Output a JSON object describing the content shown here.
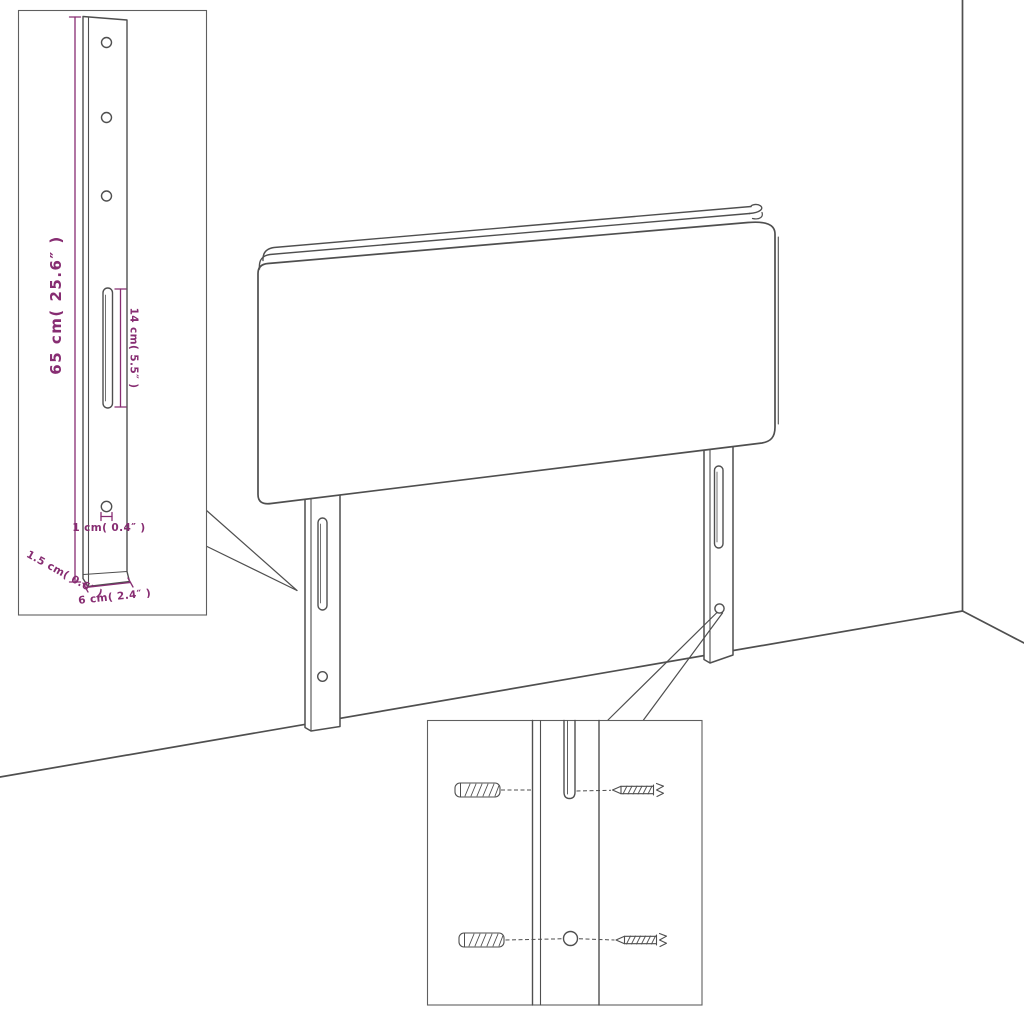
{
  "labels": {
    "height": "65 cm( 25.6″ )",
    "slot_length": "14 cm( 5.5″ )",
    "hole_diameter": "1 cm( 0.4″ )",
    "thickness": "1.5 cm( 0.6″ )",
    "width": "6 cm( 2.4″ )"
  },
  "colors": {
    "line": "#4f4f4f",
    "dimension": "#872d72",
    "background": "#ffffff"
  }
}
